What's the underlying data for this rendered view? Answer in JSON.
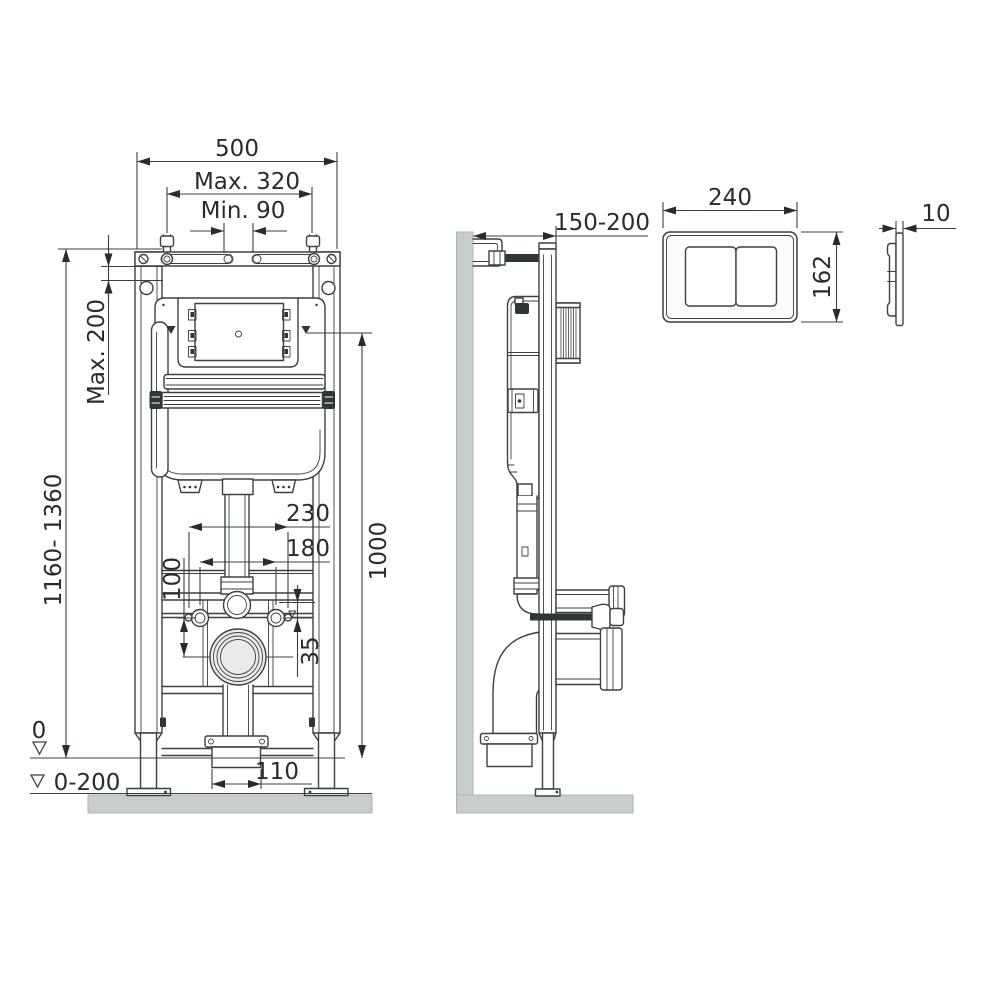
{
  "front_view": {
    "frame_width": "500",
    "fixing_max": "Max. 320",
    "fixing_min": "Min. 90",
    "top_offset_max": "Max. 200",
    "height_range": "1160- 1360",
    "height": "1000",
    "span_outer": "230",
    "span_inner": "180",
    "drain_drop": "100",
    "bolt_offset": "35",
    "outlet_width": "110",
    "floor_level": "0",
    "floor_adjust": "0-200"
  },
  "side_view": {
    "wall_distance": "150-200"
  },
  "flush_plate": {
    "width": "240",
    "height": "162",
    "thickness": "10"
  },
  "colors": {
    "line": "#3b4142",
    "text": "#272d2e",
    "surface": "#c7cecb",
    "accent_dark": "#2f3637"
  }
}
